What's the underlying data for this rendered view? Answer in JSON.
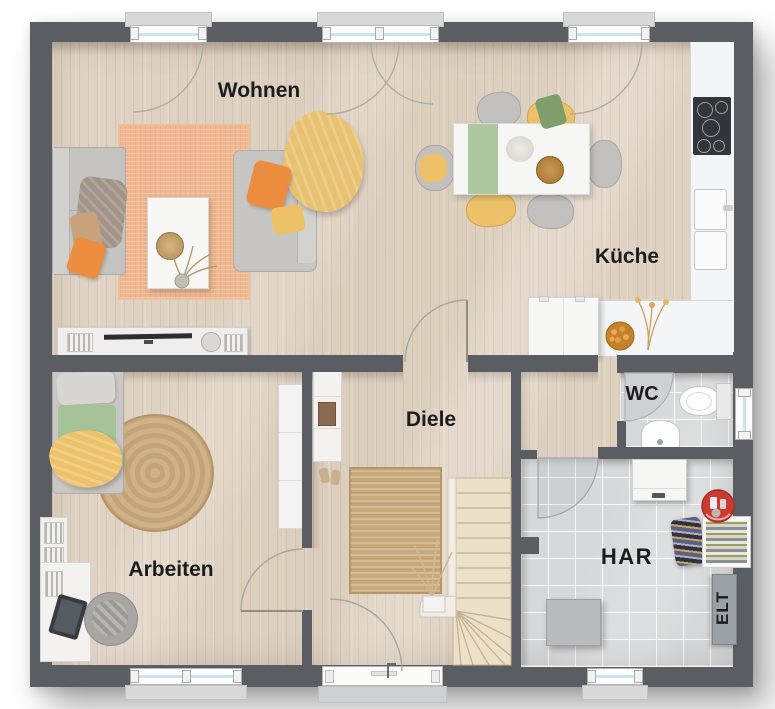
{
  "rooms": [
    {
      "id": "wohnen",
      "label": "Wohnen"
    },
    {
      "id": "kueche",
      "label": "Küche"
    },
    {
      "id": "diele",
      "label": "Diele"
    },
    {
      "id": "arbeiten",
      "label": "Arbeiten"
    },
    {
      "id": "wc",
      "label": "WC"
    },
    {
      "id": "har",
      "label": "HAR"
    },
    {
      "id": "elt",
      "label": "ELT"
    }
  ],
  "colors": {
    "wall": "#5a5d61",
    "wood": "#ddcfc0",
    "tile": "#d7d8da",
    "glass": "#c8e4f0",
    "counter": "#f4f5f6",
    "accent-orange": "#eb8c3e",
    "accent-yellow": "#ecc168",
    "accent-green": "#a6c297",
    "rug-orange": "#f0b68e",
    "rug-jute": "#c8a97c",
    "stair": "#ece0c9",
    "red": "#cd3a30"
  }
}
